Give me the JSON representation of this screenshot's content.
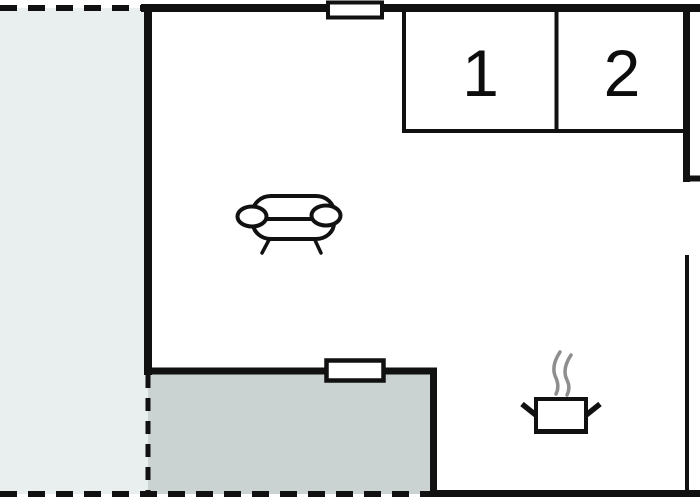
{
  "floor_plan": {
    "rooms": [
      {
        "id": "room-1",
        "label": "1"
      },
      {
        "id": "room-2",
        "label": "2"
      }
    ],
    "icons": [
      {
        "name": "sofa-icon"
      },
      {
        "name": "cooking-pot-icon"
      },
      {
        "name": "steam-icon"
      },
      {
        "name": "window-top"
      },
      {
        "name": "window-terrace"
      }
    ],
    "colors": {
      "wall": "#111111",
      "outdoor_fill": "#e9efee",
      "terrace_fill": "#cbd3d2",
      "window_fill": "#ffffff",
      "steam": "#8e8e8e",
      "background": "#ffffff"
    }
  }
}
